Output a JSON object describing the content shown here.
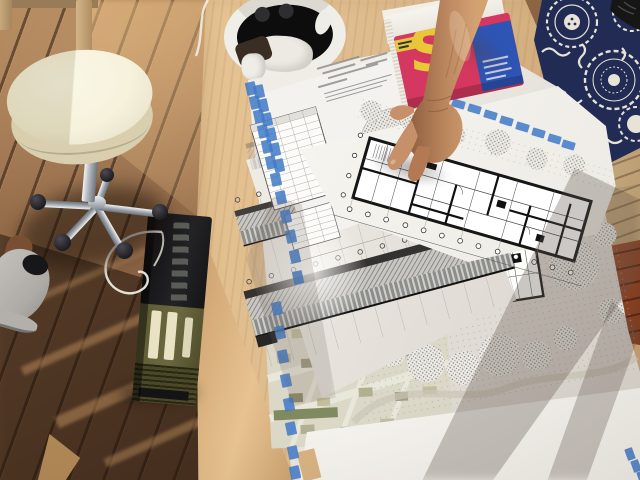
{
  "meta": {
    "width": 640,
    "height": 480,
    "kind": "photograph"
  },
  "scene": {
    "setting": "Sunlit wooden deck with a plywood worktable covered in architectural drawings; a hand points at a floor plan",
    "colors": {
      "deck_wood": "#8a6344",
      "deck_shadow": "#33241a",
      "deck_sun": "#c79a68",
      "table_wood": "#dcba8c",
      "table_edge": "#c99c6a",
      "paper": "#f4f2ed",
      "paper_shade": "#d8d3cc",
      "tape_blue": "#4079c8",
      "ink": "#1d1d1f",
      "stool_cream": "#f1ebce",
      "chrome": "#b9bec6",
      "device_olive": "#6b6840",
      "device_black": "#151517",
      "book_pink": "#d4375f",
      "book_yellow": "#e9c737",
      "book_blue": "#2e54b4",
      "skin": "#c08a63",
      "fabric_navy": "#222b53",
      "fabric_cream": "#e7e3d7",
      "chair_tan": "#c9ad82",
      "deck_red": "#9c4c2a"
    },
    "objects": [
      {
        "name": "deck-floor",
        "desc": "wooden deck boards laid diagonally with strong cast shadows and sun streaks"
      },
      {
        "name": "work-table",
        "desc": "light birch plywood table viewed from above, front edge catching the sun"
      },
      {
        "name": "rolling-stool",
        "desc": "cream round swivel stool with chrome five-star base and black casters"
      },
      {
        "name": "white-sneaker",
        "desc": "white trainer of a person standing at lower left"
      },
      {
        "name": "field-radio",
        "desc": "olive-green and black portable device standing upright against the table edge"
      },
      {
        "name": "white-cable",
        "desc": "thin white cable looping on the deck and over the table edge"
      },
      {
        "name": "vr-headset",
        "desc": "white head-mounted device lying upside down at the top edge of the table"
      },
      {
        "name": "book",
        "desc": "book with pink cover, large yellow letter and blue panel, white page block",
        "cover_letter": "S"
      },
      {
        "name": "pointing-arm",
        "desc": "sun-tanned forearm and hand pointing at the floor plan"
      },
      {
        "name": "floor-plan-sheet",
        "desc": "long rectangular building floor plan with thick black walls, bays and column bubbles"
      },
      {
        "name": "elevation-sheet",
        "desc": "two long building elevations with hatched roofs and column grid bubbles"
      },
      {
        "name": "schedule-sheet",
        "desc": "upside-down sheet with a dense data table and stippled tree drawings"
      },
      {
        "name": "site-plan",
        "desc": "landscape site plan with stippled tree clusters and a small building plan"
      },
      {
        "name": "city-map",
        "desc": "muted-colour urban map with diagonal streets and tiny blocks"
      },
      {
        "name": "blue-tape",
        "desc": "blue tape dashes along the sheet edges"
      },
      {
        "name": "patterned-garment",
        "desc": "navy fabric with white medallion pattern worn by a person at the right"
      },
      {
        "name": "deck-chair",
        "desc": "tan wooden chair edge and reddish deck boards along the right margin"
      },
      {
        "name": "shadows",
        "desc": "long diagonal shadows sweeping across the drawings"
      }
    ]
  },
  "book": {
    "cover_letter": "S"
  }
}
